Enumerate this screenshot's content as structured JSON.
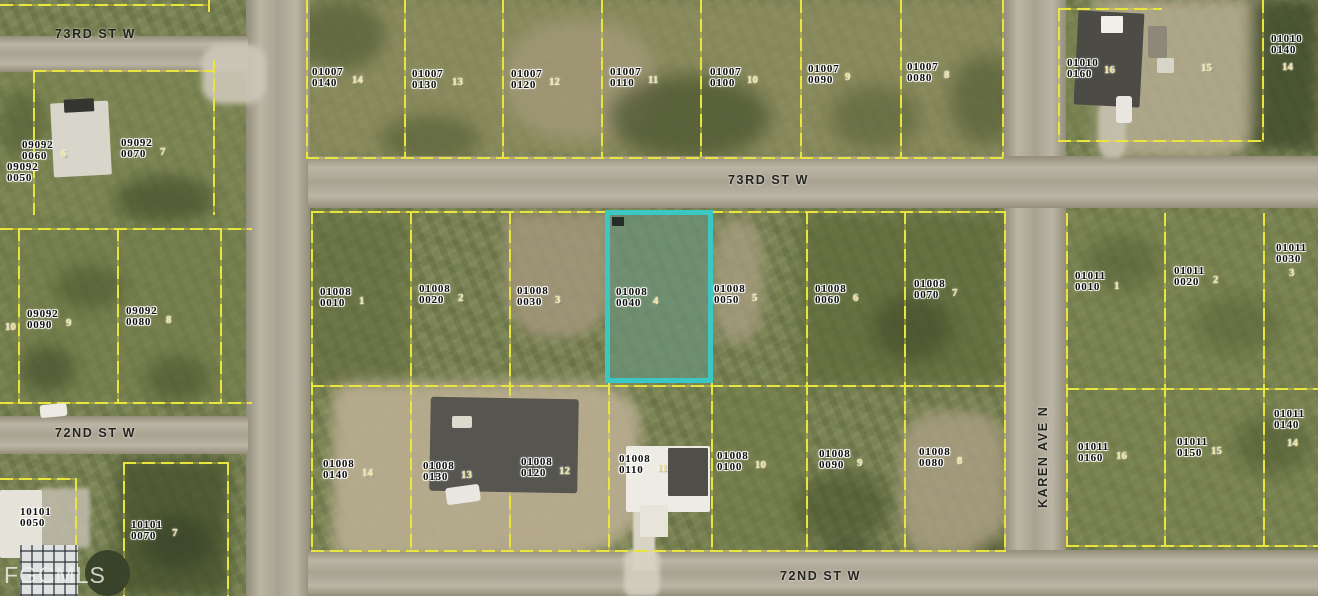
{
  "watermark": "FGCMLS",
  "highlight": {
    "apn1": "01008",
    "apn2": "0040",
    "color": "#3cc8c2",
    "x": 605,
    "y": 210,
    "w": 108,
    "h": 173
  },
  "streets": [
    {
      "name": "73RD ST W",
      "x": 55,
      "y": 27,
      "vertical": false
    },
    {
      "name": "73RD ST W",
      "x": 728,
      "y": 173,
      "vertical": false
    },
    {
      "name": "72ND ST W",
      "x": 55,
      "y": 426,
      "vertical": false
    },
    {
      "name": "72ND ST W",
      "x": 780,
      "y": 569,
      "vertical": false
    },
    {
      "name": "KAREN AVE N",
      "x": 1036,
      "y": 508,
      "vertical": true
    }
  ],
  "parcels": [
    {
      "apn1": "09092",
      "apn2": "0060",
      "lot": "6",
      "x": 22,
      "y": 140,
      "lx": 61,
      "ly": 148
    },
    {
      "apn1": "09092",
      "apn2": "0070",
      "lot": "7",
      "x": 121,
      "y": 138,
      "lx": 160,
      "ly": 146
    },
    {
      "apn1": "09092",
      "apn2": "0050",
      "lot": "",
      "x": 7,
      "y": 162,
      "lx": 0,
      "ly": 0
    },
    {
      "apn1": "",
      "apn2": "",
      "lot": "10",
      "x": 0,
      "y": 0,
      "lx": 5,
      "ly": 321
    },
    {
      "apn1": "09092",
      "apn2": "0090",
      "lot": "9",
      "x": 27,
      "y": 309,
      "lx": 66,
      "ly": 317
    },
    {
      "apn1": "09092",
      "apn2": "0080",
      "lot": "8",
      "x": 126,
      "y": 306,
      "lx": 166,
      "ly": 314
    },
    {
      "apn1": "10101",
      "apn2": "0050",
      "lot": "",
      "x": 20,
      "y": 507,
      "lx": 0,
      "ly": 0
    },
    {
      "apn1": "10101",
      "apn2": "0070",
      "lot": "7",
      "x": 131,
      "y": 520,
      "lx": 172,
      "ly": 527
    },
    {
      "apn1": "01007",
      "apn2": "0140",
      "lot": "14",
      "x": 312,
      "y": 67,
      "lx": 352,
      "ly": 74
    },
    {
      "apn1": "01007",
      "apn2": "0130",
      "lot": "13",
      "x": 412,
      "y": 69,
      "lx": 452,
      "ly": 76
    },
    {
      "apn1": "01007",
      "apn2": "0120",
      "lot": "12",
      "x": 511,
      "y": 69,
      "lx": 549,
      "ly": 76
    },
    {
      "apn1": "01007",
      "apn2": "0110",
      "lot": "11",
      "x": 610,
      "y": 67,
      "lx": 648,
      "ly": 74
    },
    {
      "apn1": "01007",
      "apn2": "0100",
      "lot": "10",
      "x": 710,
      "y": 67,
      "lx": 747,
      "ly": 74
    },
    {
      "apn1": "01007",
      "apn2": "0090",
      "lot": "9",
      "x": 808,
      "y": 64,
      "lx": 845,
      "ly": 71
    },
    {
      "apn1": "01007",
      "apn2": "0080",
      "lot": "8",
      "x": 907,
      "y": 62,
      "lx": 944,
      "ly": 69
    },
    {
      "apn1": "01010",
      "apn2": "0160",
      "lot": "16",
      "x": 1067,
      "y": 58,
      "lx": 1104,
      "ly": 64
    },
    {
      "apn1": "",
      "apn2": "",
      "lot": "15",
      "x": 0,
      "y": 0,
      "lx": 1201,
      "ly": 62
    },
    {
      "apn1": "01010",
      "apn2": "0140",
      "lot": "14",
      "x": 1271,
      "y": 34,
      "lx": 1282,
      "ly": 61
    },
    {
      "apn1": "01008",
      "apn2": "0010",
      "lot": "1",
      "x": 320,
      "y": 287,
      "lx": 359,
      "ly": 295
    },
    {
      "apn1": "01008",
      "apn2": "0020",
      "lot": "2",
      "x": 419,
      "y": 284,
      "lx": 458,
      "ly": 292
    },
    {
      "apn1": "01008",
      "apn2": "0030",
      "lot": "3",
      "x": 517,
      "y": 286,
      "lx": 555,
      "ly": 294
    },
    {
      "apn1": "01008",
      "apn2": "0040",
      "lot": "4",
      "x": 616,
      "y": 287,
      "lx": 653,
      "ly": 295
    },
    {
      "apn1": "01008",
      "apn2": "0050",
      "lot": "5",
      "x": 714,
      "y": 284,
      "lx": 752,
      "ly": 292
    },
    {
      "apn1": "01008",
      "apn2": "0060",
      "lot": "6",
      "x": 815,
      "y": 284,
      "lx": 853,
      "ly": 292
    },
    {
      "apn1": "01008",
      "apn2": "0070",
      "lot": "7",
      "x": 914,
      "y": 279,
      "lx": 952,
      "ly": 287
    },
    {
      "apn1": "01011",
      "apn2": "0010",
      "lot": "1",
      "x": 1075,
      "y": 271,
      "lx": 1114,
      "ly": 280
    },
    {
      "apn1": "01011",
      "apn2": "0020",
      "lot": "2",
      "x": 1174,
      "y": 266,
      "lx": 1213,
      "ly": 274
    },
    {
      "apn1": "01011",
      "apn2": "0030",
      "lot": "3",
      "x": 1276,
      "y": 243,
      "lx": 1289,
      "ly": 267
    },
    {
      "apn1": "01008",
      "apn2": "0140",
      "lot": "14",
      "x": 323,
      "y": 459,
      "lx": 362,
      "ly": 467
    },
    {
      "apn1": "01008",
      "apn2": "0130",
      "lot": "13",
      "x": 423,
      "y": 461,
      "lx": 461,
      "ly": 469
    },
    {
      "apn1": "01008",
      "apn2": "0120",
      "lot": "12",
      "x": 521,
      "y": 457,
      "lx": 559,
      "ly": 465
    },
    {
      "apn1": "01008",
      "apn2": "0110",
      "lot": "11",
      "x": 619,
      "y": 454,
      "lx": 657,
      "ly": 462
    },
    {
      "apn1": "01008",
      "apn2": "0100",
      "lot": "10",
      "x": 717,
      "y": 451,
      "lx": 755,
      "ly": 459
    },
    {
      "apn1": "01008",
      "apn2": "0090",
      "lot": "9",
      "x": 819,
      "y": 449,
      "lx": 857,
      "ly": 457
    },
    {
      "apn1": "01008",
      "apn2": "0080",
      "lot": "8",
      "x": 919,
      "y": 447,
      "lx": 957,
      "ly": 455
    },
    {
      "apn1": "01011",
      "apn2": "0160",
      "lot": "16",
      "x": 1078,
      "y": 442,
      "lx": 1116,
      "ly": 450
    },
    {
      "apn1": "01011",
      "apn2": "0150",
      "lot": "15",
      "x": 1177,
      "y": 437,
      "lx": 1211,
      "ly": 445
    },
    {
      "apn1": "01011",
      "apn2": "0140",
      "lot": "14",
      "x": 1274,
      "y": 409,
      "lx": 1287,
      "ly": 437
    }
  ]
}
